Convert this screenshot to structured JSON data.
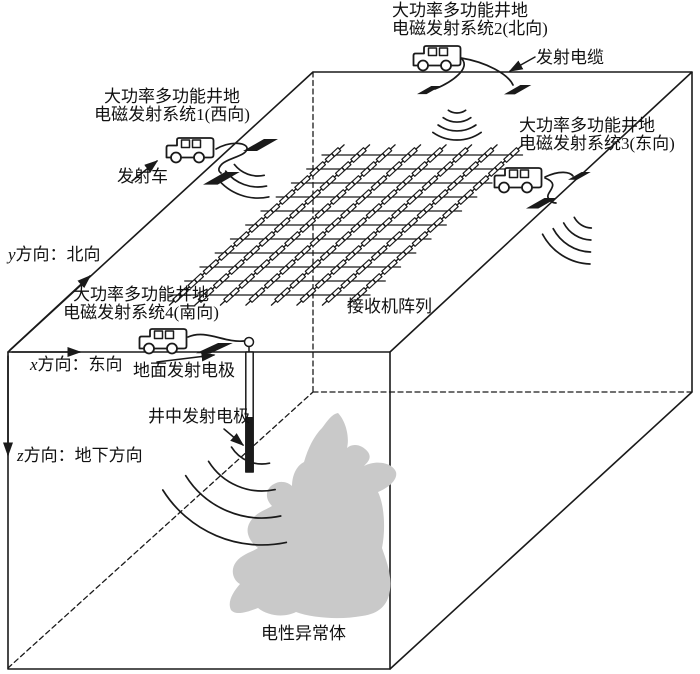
{
  "colors": {
    "ink": "#1a1a1a",
    "anomaly_fill": "#c9c9c9",
    "background": "#ffffff"
  },
  "transmitters": {
    "system1": {
      "line1": "大功率多功能井地",
      "line2": "电磁发射系统1(西向)"
    },
    "system2": {
      "line1": "大功率多功能井地",
      "line2": "电磁发射系统2(北向)"
    },
    "system3": {
      "line1": "大功率多功能井地",
      "line2": "电磁发射系统3(东向)"
    },
    "system4": {
      "line1": "大功率多功能井地",
      "line2": "电磁发射系统4(南向)"
    }
  },
  "labels": {
    "transmit_vehicle": "发射车",
    "transmit_cable": "发射电缆",
    "surface_electrode": "地面发射电极",
    "borehole_electrode": "井中发射电极",
    "receiver_array": "接收机阵列",
    "anomaly_body": "电性异常体"
  },
  "axes": {
    "y": {
      "symbol": "y",
      "text": "方向：北向"
    },
    "x": {
      "symbol": "x",
      "text": "方向：东向"
    },
    "z": {
      "symbol": "z",
      "text": "方向：地下方向"
    }
  }
}
